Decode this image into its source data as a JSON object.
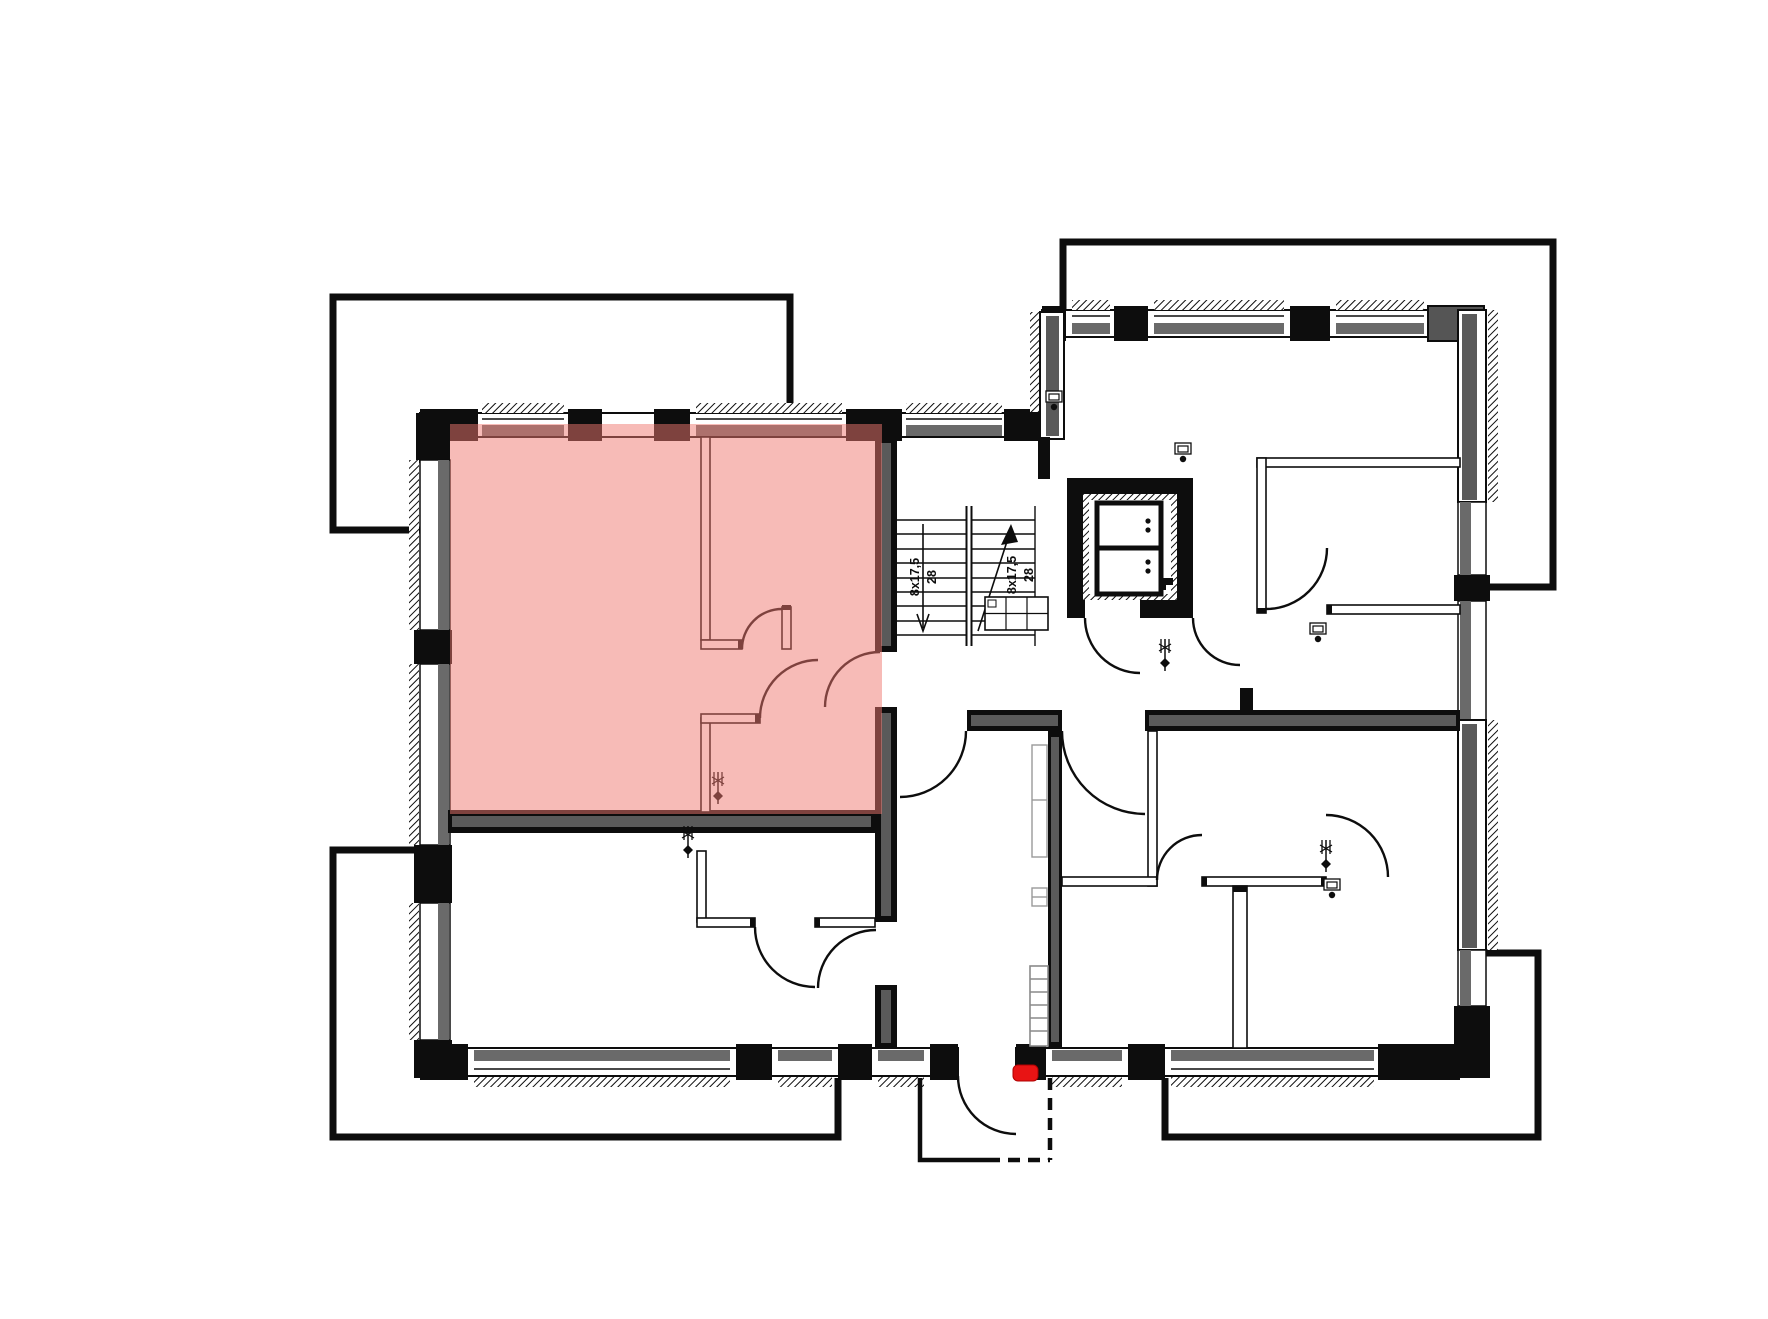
{
  "page": {
    "background_color": "#ffffff"
  },
  "floor_plan": {
    "type": "architectural floor plan with highlighted apartment unit",
    "highlighted_unit_color": "#F0786F",
    "highlighted_unit_opacity": "0.5",
    "entrance_marker_color": "#E81414",
    "wall_color": "#0d0d0d",
    "wall_core_color": "#5a5a5a",
    "window_sill_color": "#6a6a6a",
    "stairs": {
      "flight_left": {
        "riser_label": "8x17,5",
        "tread_label": "28"
      },
      "flight_right": {
        "riser_label": "8x17,5",
        "tread_label": "28"
      }
    }
  }
}
